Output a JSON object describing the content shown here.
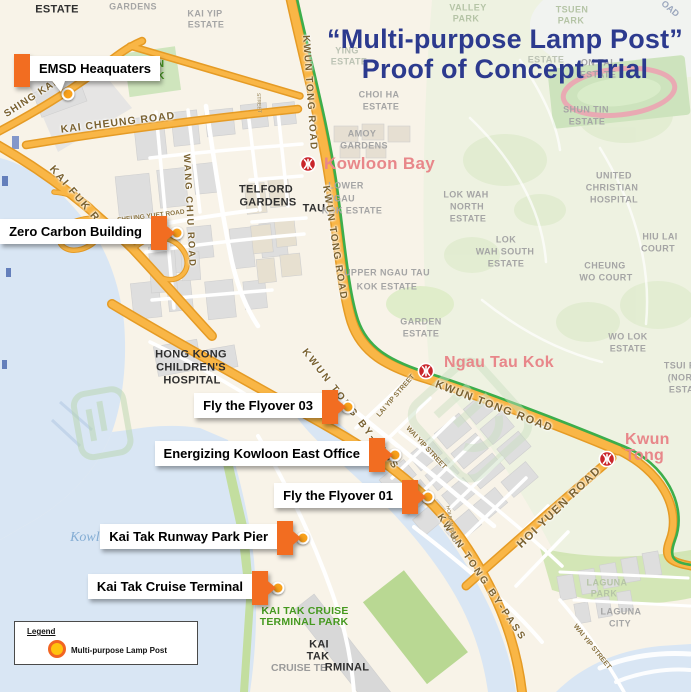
{
  "title": {
    "line1": "“Multi-purpose Lamp Post”",
    "line2": "Proof of Concept Trial"
  },
  "colors": {
    "title_navy": "#2c3a8e",
    "marker_tab_orange": "#f26d21",
    "dot_orange": "#f9a11b",
    "mtr_red": "#c9252b",
    "station_pink": "#e8878a",
    "road_orange": "#f9b646",
    "mtr_line_green": "#3cae4b",
    "water": "#d9e6f4",
    "park_green": "#45991f"
  },
  "legend": {
    "heading": "Legend",
    "items": [
      {
        "icon": "lamp-post-dot",
        "label": "Multi-purpose Lamp Post"
      }
    ]
  },
  "poi_markers": [
    {
      "id": "emsd-headquarters",
      "label": "EMSD Heaquaters",
      "tab_side": "left",
      "box": {
        "x": 30,
        "y": 56
      },
      "dot": {
        "x": 68,
        "y": 94
      }
    },
    {
      "id": "zero-carbon-building",
      "label": "Zero Carbon Building",
      "tab_side": "right",
      "dot": {
        "x": 177,
        "y": 233
      }
    },
    {
      "id": "fly-the-flyover-03",
      "label": "Fly the Flyover 03",
      "tab_side": "right",
      "dot": {
        "x": 348,
        "y": 407
      }
    },
    {
      "id": "energizing-kowloon-east-office",
      "label": "Energizing Kowloon East Office",
      "tab_side": "right",
      "dot": {
        "x": 395,
        "y": 455
      }
    },
    {
      "id": "fly-the-flyover-01",
      "label": "Fly the Flyover 01",
      "tab_side": "right",
      "dot": {
        "x": 428,
        "y": 497
      }
    },
    {
      "id": "kai-tak-runway-park-pier",
      "label": "Kai Tak Runway Park Pier",
      "tab_side": "right",
      "dot": {
        "x": 303,
        "y": 538
      }
    },
    {
      "id": "kai-tak-cruise-terminal",
      "label": "Kai Tak Cruise Terminal",
      "tab_side": "right",
      "dot": {
        "x": 278,
        "y": 588
      }
    }
  ],
  "stations": [
    {
      "name": "Kowloon Bay",
      "icon": {
        "x": 308,
        "y": 164
      },
      "text": {
        "x": 324,
        "y": 155
      },
      "fs": 17,
      "lines": [
        "Kowloon Bay"
      ]
    },
    {
      "name": "Ngau Tau Kok",
      "icon": {
        "x": 426,
        "y": 371
      },
      "text": {
        "x": 444,
        "y": 355
      },
      "fs": 16,
      "lines": [
        "Ngau Tau Kok"
      ]
    },
    {
      "name": "Kwun Tong",
      "icon": {
        "x": 607,
        "y": 459
      },
      "text": {
        "x": 625,
        "y": 432
      },
      "fs": 16,
      "lines": [
        "Kwun",
        "Tong"
      ]
    }
  ],
  "map_labels": [
    {
      "t": "ESTATE",
      "x": 57,
      "y": 10,
      "c": "dist",
      "fs": 11
    },
    {
      "t": "GARDENS",
      "x": 133,
      "y": 7,
      "c": "est"
    },
    {
      "t": "KAI YIP",
      "x": 205,
      "y": 14,
      "c": "est"
    },
    {
      "t": "ESTATE",
      "x": 206,
      "y": 25,
      "c": "est"
    },
    {
      "t": "VALLEY",
      "x": 468,
      "y": 8,
      "c": "parkf"
    },
    {
      "t": "PARK",
      "x": 466,
      "y": 19,
      "c": "parkf"
    },
    {
      "t": "TSUEN",
      "x": 572,
      "y": 10,
      "c": "parkf"
    },
    {
      "t": "PARK",
      "x": 571,
      "y": 21,
      "c": "parkf"
    },
    {
      "t": "OAD",
      "x": 670,
      "y": 9,
      "c": "roadhill",
      "rot": 40,
      "fs": 9
    },
    {
      "t": "YING",
      "x": 347,
      "y": 51,
      "c": "estf"
    },
    {
      "t": "ESTATE",
      "x": 349,
      "y": 62,
      "c": "estf"
    },
    {
      "t": "ESTATE",
      "x": 546,
      "y": 60,
      "c": "estf"
    },
    {
      "t": "ON TAI",
      "x": 597,
      "y": 63,
      "c": "est"
    },
    {
      "t": "ESTATE",
      "x": 598,
      "y": 75,
      "c": "est"
    },
    {
      "t": "CHOI HA",
      "x": 379,
      "y": 95,
      "c": "est"
    },
    {
      "t": "ESTATE",
      "x": 381,
      "y": 107,
      "c": "est"
    },
    {
      "t": "SHUN TIN",
      "x": 586,
      "y": 110,
      "c": "est"
    },
    {
      "t": "ESTATE",
      "x": 587,
      "y": 122,
      "c": "est"
    },
    {
      "t": "AMOY",
      "x": 362,
      "y": 134,
      "c": "est"
    },
    {
      "t": "GARDENS",
      "x": 364,
      "y": 146,
      "c": "est"
    },
    {
      "t": "OON",
      "x": 152,
      "y": 64,
      "c": "parkg"
    },
    {
      "t": "ARK",
      "x": 153,
      "y": 76,
      "c": "parkg"
    },
    {
      "t": "LOWER",
      "x": 346,
      "y": 186,
      "c": "est"
    },
    {
      "t": "NGAU",
      "x": 341,
      "y": 199,
      "c": "est"
    },
    {
      "t": "TAU",
      "x": 314,
      "y": 209,
      "c": "dist",
      "fs": 11
    },
    {
      "t": "KOK ESTATE",
      "x": 352,
      "y": 211,
      "c": "est"
    },
    {
      "t": "TELFORD",
      "x": 266,
      "y": 190,
      "c": "dist",
      "fs": 11
    },
    {
      "t": "GARDENS",
      "x": 268,
      "y": 203,
      "c": "dist",
      "fs": 11
    },
    {
      "t": "LOK WAH",
      "x": 466,
      "y": 195,
      "c": "est"
    },
    {
      "t": "NORTH",
      "x": 467,
      "y": 207,
      "c": "est"
    },
    {
      "t": "ESTATE",
      "x": 468,
      "y": 219,
      "c": "est"
    },
    {
      "t": "UNITED",
      "x": 614,
      "y": 176,
      "c": "est"
    },
    {
      "t": "CHRISTIAN",
      "x": 612,
      "y": 188,
      "c": "est"
    },
    {
      "t": "HOSPITAL",
      "x": 614,
      "y": 200,
      "c": "est"
    },
    {
      "t": "HIU LAI",
      "x": 660,
      "y": 237,
      "c": "est"
    },
    {
      "t": "COURT",
      "x": 658,
      "y": 249,
      "c": "est"
    },
    {
      "t": "LOK",
      "x": 506,
      "y": 240,
      "c": "est"
    },
    {
      "t": "WAH SOUTH",
      "x": 505,
      "y": 252,
      "c": "est"
    },
    {
      "t": "ESTATE",
      "x": 506,
      "y": 264,
      "c": "est"
    },
    {
      "t": "CHEUNG",
      "x": 605,
      "y": 266,
      "c": "est"
    },
    {
      "t": "WO COURT",
      "x": 606,
      "y": 278,
      "c": "est"
    },
    {
      "t": "UPPER NGAU TAU",
      "x": 387,
      "y": 273,
      "c": "est"
    },
    {
      "t": "KOK ESTATE",
      "x": 387,
      "y": 287,
      "c": "est"
    },
    {
      "t": "GARDEN",
      "x": 421,
      "y": 322,
      "c": "est"
    },
    {
      "t": "ESTATE",
      "x": 421,
      "y": 334,
      "c": "est"
    },
    {
      "t": "WO LOK",
      "x": 628,
      "y": 337,
      "c": "est"
    },
    {
      "t": "ESTATE",
      "x": 628,
      "y": 349,
      "c": "est"
    },
    {
      "t": "TSUI PI",
      "x": 681,
      "y": 366,
      "c": "est"
    },
    {
      "t": "(NORT",
      "x": 683,
      "y": 378,
      "c": "est"
    },
    {
      "t": "ESTAT",
      "x": 684,
      "y": 390,
      "c": "est"
    },
    {
      "t": "HONG KONG",
      "x": 191,
      "y": 355,
      "c": "dist",
      "fs": 11
    },
    {
      "t": "CHILDREN'S",
      "x": 191,
      "y": 368,
      "c": "dist",
      "fs": 11
    },
    {
      "t": "HOSPITAL",
      "x": 192,
      "y": 381,
      "c": "dist",
      "fs": 11
    },
    {
      "t": "LAGUNA",
      "x": 607,
      "y": 583,
      "c": "parkf"
    },
    {
      "t": "PARK",
      "x": 604,
      "y": 594,
      "c": "parkf"
    },
    {
      "t": "LAGUNA",
      "x": 621,
      "y": 612,
      "c": "est"
    },
    {
      "t": "CITY",
      "x": 620,
      "y": 624,
      "c": "est"
    },
    {
      "t": "KAI TAK CRUISE",
      "x": 305,
      "y": 611,
      "c": "parkg"
    },
    {
      "t": "TERMINAL PARK",
      "x": 304,
      "y": 622,
      "c": "parkg"
    },
    {
      "t": "KAI",
      "x": 319,
      "y": 645,
      "c": "dist",
      "fs": 11
    },
    {
      "t": "TAK",
      "x": 318,
      "y": 657,
      "c": "dist",
      "fs": 11
    },
    {
      "t": "CRUISE TE",
      "x": 299,
      "y": 668,
      "c": "termgray"
    },
    {
      "t": "RMINAL",
      "x": 347,
      "y": 668,
      "c": "dist",
      "fs": 11
    },
    {
      "t": "Kowloon Bay",
      "x": 108,
      "y": 538,
      "c": "water-lbl",
      "fs": 14
    },
    {
      "t": "SHING KAI",
      "x": 31,
      "y": 99,
      "c": "road",
      "rot": -33,
      "fs": 10,
      "ls": 1
    },
    {
      "t": "KAI CHEUNG ROAD",
      "x": 118,
      "y": 123,
      "c": "road",
      "rot": -7,
      "fs": 10.5,
      "ls": 1
    },
    {
      "t": "KAI FUK RO",
      "x": 78,
      "y": 198,
      "c": "road",
      "rot": 49,
      "fs": 10.5,
      "ls": 2
    },
    {
      "t": "WANG CHIU ROAD",
      "x": 189,
      "y": 211,
      "c": "road",
      "rot": 87,
      "fs": 9.5,
      "ls": 2
    },
    {
      "t": "SHEUNG YUET ROAD",
      "x": 151,
      "y": 217,
      "c": "roadsm",
      "rot": -7,
      "fs": 6.5
    },
    {
      "t": "KWUN TONG ROAD",
      "x": 309,
      "y": 93,
      "c": "road",
      "rot": 86,
      "fs": 10,
      "ls": 1.5
    },
    {
      "t": "KWUN TONG ROAD",
      "x": 334,
      "y": 243,
      "c": "road",
      "rot": 81,
      "fs": 10,
      "ls": 1.5
    },
    {
      "t": "KWUN TONG ROAD",
      "x": 494,
      "y": 407,
      "c": "road",
      "rot": 21,
      "fs": 11,
      "ls": 1.5
    },
    {
      "t": "KWUN TONG BY-PASS",
      "x": 350,
      "y": 410,
      "c": "road",
      "rot": 52,
      "fs": 10,
      "ls": 2.5
    },
    {
      "t": "KWUN TONG BY-PASS",
      "x": 481,
      "y": 578,
      "c": "road",
      "rot": 56,
      "fs": 10,
      "ls": 2.5
    },
    {
      "t": "LAI YIP STREET",
      "x": 396,
      "y": 396,
      "c": "roadsm",
      "rot": -49,
      "fs": 7
    },
    {
      "t": "WAI YIP STREET",
      "x": 426,
      "y": 448,
      "c": "roadsm",
      "rot": 47,
      "fs": 7
    },
    {
      "t": "WAI YIP STREET",
      "x": 592,
      "y": 647,
      "c": "roadsm",
      "rot": 51,
      "fs": 7
    },
    {
      "t": "HOI YUEN ROAD",
      "x": 560,
      "y": 508,
      "c": "road",
      "rot": -44,
      "fs": 11.5,
      "ls": 1.5
    },
    {
      "t": "HOI BUN ROAD",
      "x": 450,
      "y": 524,
      "c": "roadtiny",
      "rot": 80,
      "fs": 5
    },
    {
      "t": "STREET",
      "x": 258,
      "y": 103,
      "c": "roadtiny",
      "rot": 87,
      "fs": 5
    }
  ]
}
